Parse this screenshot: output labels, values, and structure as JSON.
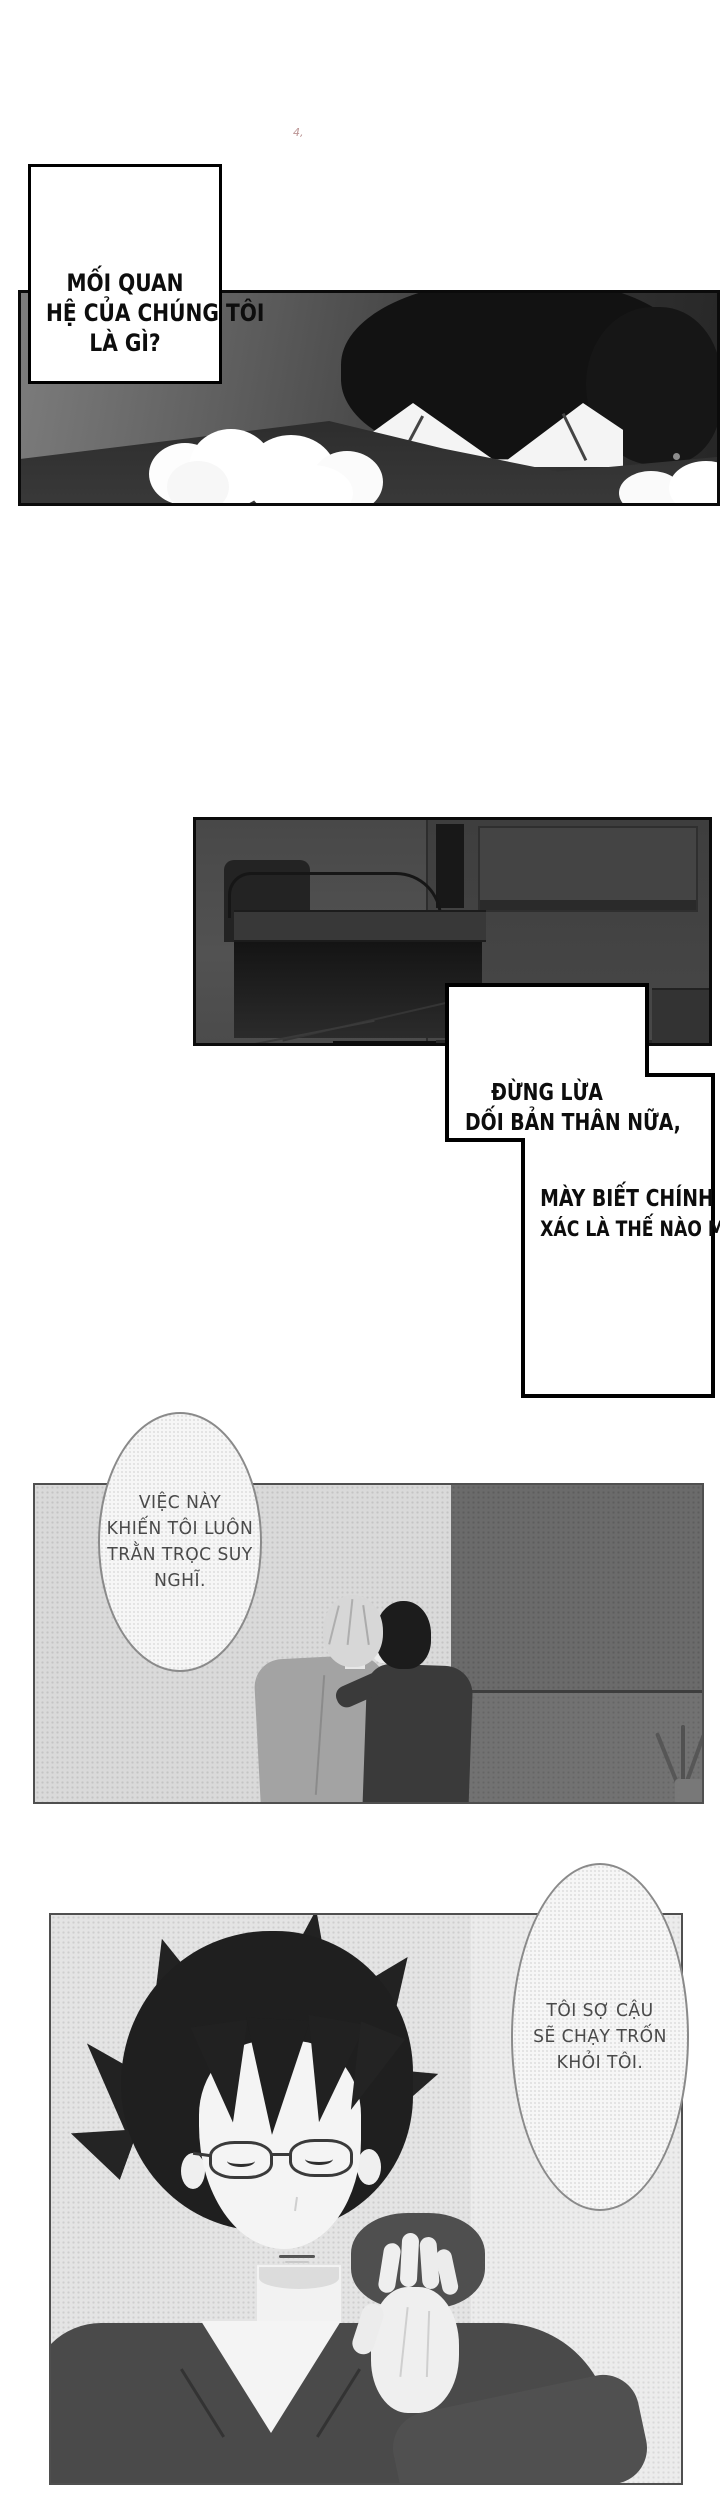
{
  "page_mark": "4,",
  "dialog": {
    "caption": {
      "lines": [
        "MỐI QUAN",
        "HỆ CỦA CHÚNG TÔI",
        "LÀ GÌ?"
      ]
    },
    "box1": {
      "lines": [
        "ĐỪNG LỪA",
        "DỐI BẢN THÂN NỮA,"
      ]
    },
    "box2": {
      "lines": [
        "MÀY BIẾT CHÍNH",
        "XÁC LÀ THẾ NÀO MÀ."
      ]
    },
    "bubble1": {
      "lines": [
        "VIỆC NÀY",
        "KHIẾN TÔI LUÔN",
        "TRẰN TRỌC SUY",
        "NGHĨ."
      ]
    },
    "bubble2": {
      "lines": [
        "TÔI SỢ CẬU",
        "SẼ CHẠY TRỐN",
        "KHỎI TÔI."
      ]
    }
  },
  "colors": {
    "page_bg": "#ffffff",
    "panel_border_dark": "#0b0b0b",
    "panel_border_gray": "#4f4f4f",
    "ink": "#0d0d0d",
    "bubble_text": "#4a4a4a",
    "halftone_light": "#dadada",
    "wall_dark": "#6b6b6b",
    "shirt_dark": "#4a4a4a"
  }
}
